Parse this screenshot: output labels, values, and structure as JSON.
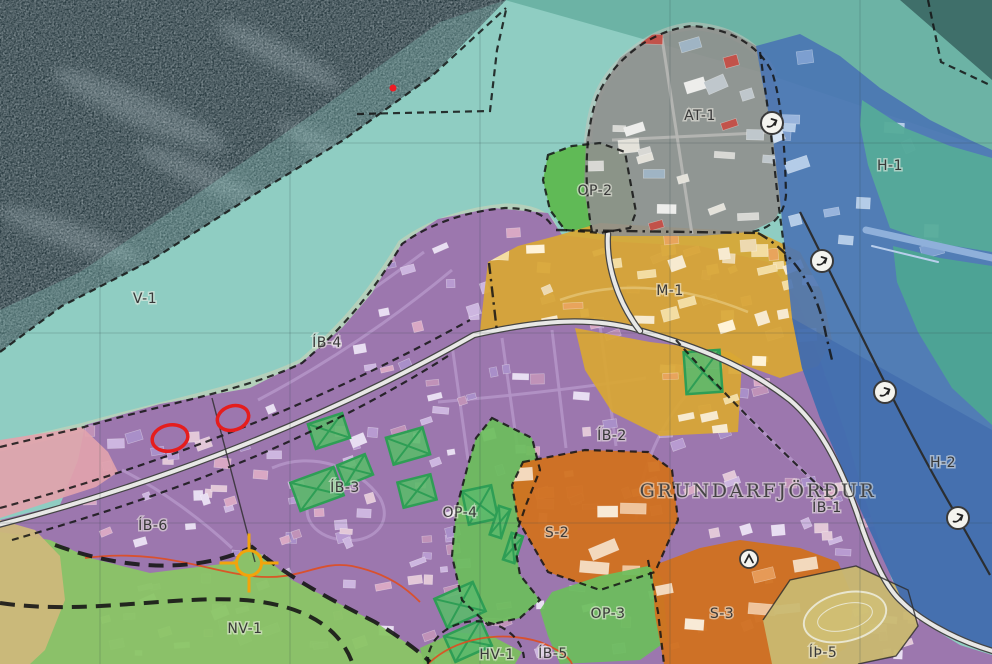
{
  "map": {
    "size": {
      "w": 992,
      "h": 664
    },
    "colors": {
      "sea": "#8fcdc2",
      "sea_mid": "#68b0a2",
      "sea_dark": "#24363c",
      "residential_purple": "#9c74ad",
      "centre_yellow": "#d9a733",
      "industry_gray": "#90908e",
      "open_green": "#6cbd5c",
      "nature_green": "#8ac565",
      "institution_orange": "#d1711f",
      "harbor_blue": "#4a74b4",
      "harbor_deep": "#3e68ac",
      "bay_teal": "#4da593",
      "sports_khaki": "#c9b870",
      "pink_zone": "#e2a3ad",
      "tan_zone": "#cdb87b",
      "road_casing": "#454545",
      "road_fill": "#e8e8e6",
      "boundary": "#141414",
      "annotation_red": "#e51d1d",
      "crosshair_yellow": "#f2a40c",
      "hatch_green": "#2e9e55"
    },
    "sea": {
      "mid_poly": "505,0 992,0 992,150 760,72",
      "dark_poly": "0,0 506,0 432,76 342,141 252,196 150,261 62,306 0,352",
      "dark_corner": "900,0 992,0 992,80",
      "overlay_poly": "506,0 432,76 342,141 252,196 150,261 62,306 0,352 0,310 80,272 200,192 330,102 440,22",
      "streaks": [
        [
          140,
          110,
          95,
          16,
          24
        ],
        [
          280,
          55,
          70,
          13,
          27
        ],
        [
          70,
          235,
          75,
          13,
          20
        ],
        [
          330,
          150,
          60,
          11,
          28
        ],
        [
          200,
          175,
          70,
          12,
          24
        ]
      ]
    },
    "beach": [
      {
        "d": "M 0 447 L 84 427 C 160 405 250 389 302 363 C 342 329 372 294 402 244 C 432 222 470 211 505 208 C 528 208 546 214 552 226",
        "s": "#d9d3b4",
        "w": 9,
        "o": 0.5
      },
      {
        "d": "M 592 232 C 584 190 584 130 598 95 C 612 62 650 30 692 26 C 728 28 758 44 772 72",
        "s": "#c9c6bb",
        "w": 8,
        "o": 0.5
      }
    ],
    "zones": [
      {
        "id": "ib-residential",
        "fill": "#9c74ad",
        "opacity": 0.96,
        "points": "85,425 160,404 250,388 302,362 342,328 372,293 402,243 438,219 492,208 548,213 562,235 620,242 700,246 768,262 798,300 820,360 845,432 866,502 892,580 922,622 960,645 992,655 992,664 0,664 0,520 60,505 78,460"
      },
      {
        "id": "nv1",
        "fill": "#8ac565",
        "opacity": 0.95,
        "points": "0,532 50,540 90,558 150,573 230,563 252,547 292,580 332,600 375,622 420,652 430,664 0,664"
      },
      {
        "id": "tan-strip",
        "fill": "#cdb87b",
        "opacity": 0.95,
        "points": "0,520 35,530 60,556 65,600 45,650 30,664 0,664"
      },
      {
        "id": "pink",
        "fill": "#e2a3ad",
        "opacity": 0.92,
        "points": "0,440 82,427 108,452 118,472 96,487 40,505 0,518"
      },
      {
        "id": "op4",
        "fill": "#6cbd5c",
        "opacity": 0.93,
        "points": "492,418 532,438 540,470 526,505 514,540 520,575 540,600 520,618 488,625 462,600 452,556 456,510 468,465 476,438"
      },
      {
        "id": "s2",
        "fill": "#d1711f",
        "opacity": 0.95,
        "points": "523,462 585,450 648,452 672,470 678,520 655,572 600,590 548,572 518,520 512,485"
      },
      {
        "id": "op3",
        "fill": "#6cbd5c",
        "opacity": 0.93,
        "points": "540,610 548,636 560,664 640,660 668,640 662,578 648,566 600,576 552,592"
      },
      {
        "id": "s3",
        "fill": "#d1711f",
        "opacity": 0.95,
        "points": "652,566 700,548 740,540 800,548 838,562 854,600 846,648 820,664 664,664 655,615"
      },
      {
        "id": "ith5",
        "fill": "#c9b870",
        "opacity": 0.95,
        "points": "763,620 790,580 856,566 908,590 918,626 896,656 858,664 772,664"
      },
      {
        "id": "hv1",
        "fill": "#7cc05e",
        "opacity": 0.93,
        "points": "420,648 455,632 492,636 522,652 515,664 424,664"
      },
      {
        "id": "op2",
        "fill": "#5db84e",
        "opacity": 0.93,
        "points": "548,155 572,146 600,143 625,152 630,180 636,212 630,228 600,233 565,230 550,210 543,180"
      },
      {
        "id": "m1",
        "fill": "#d9a733",
        "opacity": 0.92,
        "points": "488,262 518,246 556,236 600,223 665,227 758,232 800,252 822,292 832,340 818,366 780,378 730,360 700,348 650,332 613,322 545,326 480,331 484,295"
      },
      {
        "id": "m1-south",
        "fill": "#d9a733",
        "opacity": 0.92,
        "points": "575,328 650,342 730,352 742,360 738,432 660,436 612,412 585,370"
      },
      {
        "id": "at1",
        "fill": "#90908e",
        "opacity": 0.9,
        "points": "592,232 584,190 586,140 598,95 620,58 652,35 692,26 728,30 756,46 772,72 780,105 784,150 786,195 775,220 750,232 700,236 640,236 610,236"
      },
      {
        "id": "harbor",
        "fill": "#4a74b4",
        "opacity": 0.9,
        "points": "756,46 800,34 840,56 880,88 930,120 970,140 992,150 992,648 935,627 902,600 866,522 843,470 820,418 802,368 792,318 786,262 780,200 772,130 762,80"
      },
      {
        "id": "harbor-deep",
        "fill": "#3e68ac",
        "opacity": 0.6,
        "points": "792,318 992,430 992,648 935,627 902,600 866,522 843,470 820,418 802,368"
      },
      {
        "id": "bay-ne",
        "fill": "#55ab99",
        "opacity": 0.95,
        "points": "862,100 905,128 950,146 992,158 992,252 930,242 890,228 868,165 860,125"
      },
      {
        "id": "bay-e",
        "fill": "#4da593",
        "opacity": 0.95,
        "points": "893,246 940,258 992,266 992,425 952,388 918,332 897,282"
      }
    ],
    "streets": [
      {
        "zone": "ib-residential",
        "d": "M 228 374 C 300 340 360 300 424 252",
        "s": "#b493c6",
        "w": 3
      },
      {
        "zone": "ib-residential",
        "d": "M 258 400 C 330 362 392 320 452 270",
        "s": "#b493c6",
        "w": 3
      },
      {
        "zone": "ib-residential",
        "d": "M 452 345 L 468 460",
        "s": "#b493c6",
        "w": 3
      },
      {
        "zone": "ib-residential",
        "d": "M 502 338 L 518 452",
        "s": "#b493c6",
        "w": 3
      },
      {
        "zone": "ib-residential",
        "d": "M 552 330 L 566 448",
        "s": "#b493c6",
        "w": 3
      },
      {
        "zone": "ib-residential",
        "d": "M 600 326 L 616 446",
        "s": "#b493c6",
        "w": 3
      },
      {
        "zone": "ib-residential",
        "d": "M 438 402 C 510 396 580 388 646 378",
        "s": "#b493c6",
        "w": 3
      },
      {
        "zone": "ib-residential",
        "d": "M 272 468 C 312 450 360 468 380 498 C 394 524 372 544 342 540 C 310 536 300 512 312 496",
        "s": "#b493c6",
        "w": 3
      },
      {
        "zone": "ib-residential",
        "d": "M 122 470 C 162 490 202 520 232 548",
        "s": "#b493c6",
        "w": 3
      },
      {
        "zone": "ib-residential",
        "d": "M 676 340 C 722 392 782 452 838 504",
        "s": "#b493c6",
        "w": 3.4
      },
      {
        "zone": "ib-residential",
        "d": "M 700 380 C 660 420 640 470 636 520",
        "s": "#b493c6",
        "w": 3
      },
      {
        "zone": "at1",
        "d": "M 612 140 L 778 132",
        "s": "#b7b7b5",
        "w": 3
      },
      {
        "zone": "at1",
        "d": "M 662 38 L 692 234",
        "s": "#b7b7b5",
        "w": 3
      },
      {
        "zone": "m1",
        "d": "M 560 300 C 620 278 690 288 748 312",
        "s": "#e2c06e",
        "w": 2.6
      }
    ],
    "building_groups": [
      {
        "zone": "ib-residential",
        "bbox": [
          88,
          215,
          870,
          445
        ],
        "count": 300,
        "seed": 11,
        "palette": [
          "#cdb6e0",
          "#e8def2",
          "#b89bd1",
          "#d9a8c4",
          "#c092b8",
          "#a98fc9",
          "#e3c8d8"
        ],
        "min": [
          7,
          5
        ],
        "max": [
          17,
          11
        ]
      },
      {
        "zone": "m1",
        "bbox": [
          495,
          228,
          330,
          140
        ],
        "count": 40,
        "seed": 23,
        "palette": [
          "#f3dda2",
          "#f7ead0",
          "#e8a45c",
          "#fff3d8",
          "#edd9b0"
        ],
        "min": [
          9,
          6
        ],
        "max": [
          20,
          13
        ]
      },
      {
        "zone": "m1-south",
        "bbox": [
          580,
          335,
          158,
          98
        ],
        "count": 10,
        "seed": 31,
        "palette": [
          "#f3dda2",
          "#f7ead0",
          "#e8a45c"
        ],
        "min": [
          9,
          6
        ],
        "max": [
          18,
          12
        ]
      },
      {
        "zone": "at1",
        "bbox": [
          590,
          32,
          194,
          202
        ],
        "count": 26,
        "seed": 41,
        "palette": [
          "#ededeb",
          "#d8d8d4",
          "#bfc7cc",
          "#9fb4c4",
          "#c2524a",
          "#e4e2da"
        ],
        "min": [
          9,
          6
        ],
        "max": [
          22,
          14
        ]
      },
      {
        "zone": "harbor",
        "bbox": [
          766,
          56,
          182,
          258
        ],
        "count": 15,
        "seed": 52,
        "palette": [
          "#b4cce8",
          "#d6e4f4",
          "#7d9fd0",
          "#98b4dc"
        ],
        "min": [
          10,
          7
        ],
        "max": [
          24,
          14
        ]
      },
      {
        "zone": "s2",
        "bbox": [
          516,
          456,
          160,
          132
        ],
        "count": 6,
        "seed": 61,
        "palette": [
          "#f3d9bd",
          "#efc49c",
          "#f8ead6",
          "#e69a57"
        ],
        "min": [
          14,
          8
        ],
        "max": [
          30,
          14
        ]
      },
      {
        "zone": "s3",
        "bbox": [
          656,
          546,
          196,
          116
        ],
        "count": 7,
        "seed": 71,
        "palette": [
          "#f3d9bd",
          "#efc49c",
          "#f8ead6",
          "#e69a57"
        ],
        "min": [
          14,
          8
        ],
        "max": [
          30,
          14
        ]
      }
    ],
    "sports_oval": {
      "cx": 845,
      "cy": 617,
      "rx": 42,
      "ry": 24,
      "rot": -14
    },
    "pier": [
      {
        "d": "M 866 230 L 992 258",
        "s": "#8fb0da",
        "w": 7
      },
      {
        "d": "M 872 246 L 938 262",
        "s": "#b9cfec",
        "w": 2
      }
    ],
    "hatch_blocks": [
      [
        329,
        431,
        36,
        26,
        -18
      ],
      [
        408,
        446,
        38,
        28,
        -16
      ],
      [
        317,
        489,
        46,
        30,
        -20
      ],
      [
        355,
        470,
        30,
        22,
        -22
      ],
      [
        417,
        491,
        34,
        26,
        -14
      ],
      [
        480,
        505,
        30,
        34,
        -12
      ],
      [
        703,
        372,
        36,
        42,
        -4
      ],
      [
        460,
        605,
        42,
        32,
        -24
      ],
      [
        468,
        641,
        40,
        28,
        -24
      ],
      [
        500,
        522,
        12,
        30,
        18
      ],
      [
        513,
        548,
        12,
        28,
        18
      ]
    ],
    "roads": [
      {
        "d": "M -6 526 C 120 494 300 434 474 335 C 540 320 592 316 642 331 C 694 346 744 364 790 400 C 816 422 838 458 858 516 C 872 558 886 588 902 602 C 916 616 948 638 996 652"
      },
      {
        "d": "M 640 331 C 616 300 606 262 608 234"
      }
    ],
    "contours": [
      {
        "d": "M 85 558 C 160 548 210 572 252 576 C 300 582 318 560 352 566 C 390 574 408 590 420 602"
      },
      {
        "d": "M 428 664 C 455 638 500 630 540 642 C 560 650 570 658 572 664"
      }
    ],
    "boundaries": [
      {
        "d": "M 0 352 L 62 306 L 150 261 L 252 196 L 342 141 L 432 76 L 506 8",
        "style": "dash"
      },
      {
        "d": "M 357 114 L 490 111 L 497 50 L 506 10",
        "style": "dash"
      },
      {
        "d": "M 928 0 L 941 62 L 992 86",
        "style": "dash"
      },
      {
        "d": "M 0 447 L 84 427 C 160 405 250 389 302 363 C 342 329 372 294 402 244 C 432 222 470 211 505 208 C 528 208 546 214 552 226",
        "style": "dash"
      },
      {
        "d": "M 548 155 L 572 146 L 600 143 L 625 152 L 630 180 L 636 212 L 630 228 L 600 233 L 565 230 L 550 210 L 543 180 Z",
        "style": "dash"
      },
      {
        "d": "M 592 232 C 584 190 584 130 598 95 C 612 62 650 30 692 26 C 728 28 758 44 772 72 C 782 102 785 150 786 195 C 784 218 768 230 750 232",
        "style": "dash"
      },
      {
        "d": "M 760 52 L 770 125 L 778 200 L 786 262",
        "style": "dash"
      },
      {
        "d": "M 489 263 L 497 332",
        "style": "dashdot"
      },
      {
        "d": "M 556 230 L 756 233",
        "style": "dashdot"
      },
      {
        "d": "M 758 233 C 796 254 818 292 826 335 L 832 360",
        "style": "dashdot"
      },
      {
        "d": "M 0 508 C 140 470 300 414 470 320",
        "style": "dash"
      },
      {
        "d": "M 12 540 C 150 500 300 450 448 356",
        "style": "dash"
      },
      {
        "d": "M 55 545 C 140 576 210 568 252 547 C 292 580 332 600 375 622 C 400 637 420 652 430 662",
        "style": "bold"
      },
      {
        "d": "M 0 603 C 90 616 180 593 255 601 C 310 608 340 630 352 662",
        "style": "bold"
      },
      {
        "d": "M 492 418 L 532 438 L 540 470 L 526 505 L 514 540 L 520 575 L 540 600 L 520 618 L 488 625 L 462 600 L 452 556 L 456 510 L 468 465 L 476 438 Z",
        "style": "dash"
      },
      {
        "d": "M 523 462 L 585 450 L 648 452 L 672 470 L 678 520 L 655 572 L 600 590 L 548 572 L 518 520 L 512 485 Z",
        "style": "dash"
      },
      {
        "d": "M 648 560 L 658 612 L 664 664",
        "style": "dash"
      },
      {
        "d": "M 428 664 A 46 38 0 0 1 524 658",
        "style": "dash"
      },
      {
        "d": "M 676 340 C 722 392 782 452 838 504",
        "style": "dash"
      },
      {
        "d": "M 763 620 L 790 580 L 856 566 L 908 590 L 918 626 L 896 656 L 858 664",
        "style": "thin"
      },
      {
        "d": "M 212 398 L 255 562",
        "style": "thin"
      },
      {
        "d": "M 800 212 C 840 290 900 420 958 518 L 990 575",
        "style": "solid2"
      }
    ],
    "grid": {
      "xs": [
        100,
        290,
        480,
        670,
        860
      ],
      "ys": [
        143,
        333,
        523
      ]
    },
    "markers": {
      "arrows": [
        [
          772,
          123
        ],
        [
          822,
          261
        ],
        [
          885,
          392
        ],
        [
          958,
          518
        ]
      ],
      "chevrons": [
        [
          749,
          559
        ]
      ]
    },
    "labels": [
      {
        "id": "v1",
        "text": "V-1",
        "x": 145,
        "y": 303,
        "kind": "zone"
      },
      {
        "id": "ib4",
        "text": "ÍB-4",
        "x": 327,
        "y": 347,
        "kind": "zone"
      },
      {
        "id": "ib6",
        "text": "ÍB-6",
        "x": 153,
        "y": 530,
        "kind": "zone"
      },
      {
        "id": "ib3",
        "text": "ÍB-3",
        "x": 345,
        "y": 492,
        "kind": "zone"
      },
      {
        "id": "ib2",
        "text": "ÍB-2",
        "x": 612,
        "y": 440,
        "kind": "zone"
      },
      {
        "id": "ib1",
        "text": "ÍB-1",
        "x": 827,
        "y": 512,
        "kind": "zone"
      },
      {
        "id": "town",
        "text": "GRUNDARFJÖRÐUR",
        "x": 758,
        "y": 497,
        "kind": "town"
      },
      {
        "id": "m1",
        "text": "M-1",
        "x": 670,
        "y": 295,
        "kind": "zone"
      },
      {
        "id": "at1",
        "text": "AT-1",
        "x": 700,
        "y": 120,
        "kind": "zone"
      },
      {
        "id": "op2",
        "text": "OP-2",
        "x": 595,
        "y": 195,
        "kind": "zone"
      },
      {
        "id": "op4",
        "text": "OP-4",
        "x": 460,
        "y": 517,
        "kind": "zone"
      },
      {
        "id": "op3",
        "text": "OP-3",
        "x": 608,
        "y": 618,
        "kind": "zone"
      },
      {
        "id": "s2",
        "text": "S-2",
        "x": 557,
        "y": 537,
        "kind": "zone"
      },
      {
        "id": "s3",
        "text": "S-3",
        "x": 722,
        "y": 618,
        "kind": "zone"
      },
      {
        "id": "h1",
        "text": "H-1",
        "x": 890,
        "y": 170,
        "kind": "zone"
      },
      {
        "id": "h2",
        "text": "H-2",
        "x": 943,
        "y": 467,
        "kind": "zone"
      },
      {
        "id": "nv1",
        "text": "NV-1",
        "x": 245,
        "y": 633,
        "kind": "zone"
      },
      {
        "id": "hv1",
        "text": "HV-1",
        "x": 497,
        "y": 659,
        "kind": "zone"
      },
      {
        "id": "ib5",
        "text": "ÍB-5",
        "x": 553,
        "y": 658,
        "kind": "zone"
      },
      {
        "id": "ith5",
        "text": "ÍÞ-5",
        "x": 823,
        "y": 657,
        "kind": "zone"
      }
    ],
    "annotations": {
      "ellipses": [
        [
          170,
          438,
          18,
          13,
          -12
        ],
        [
          233,
          418,
          16,
          12,
          -18
        ]
      ],
      "dot": {
        "x": 393,
        "y": 88,
        "r": 3.5
      },
      "crosshair": {
        "x": 249,
        "y": 563,
        "r": 12.5,
        "tick": 17
      }
    }
  }
}
